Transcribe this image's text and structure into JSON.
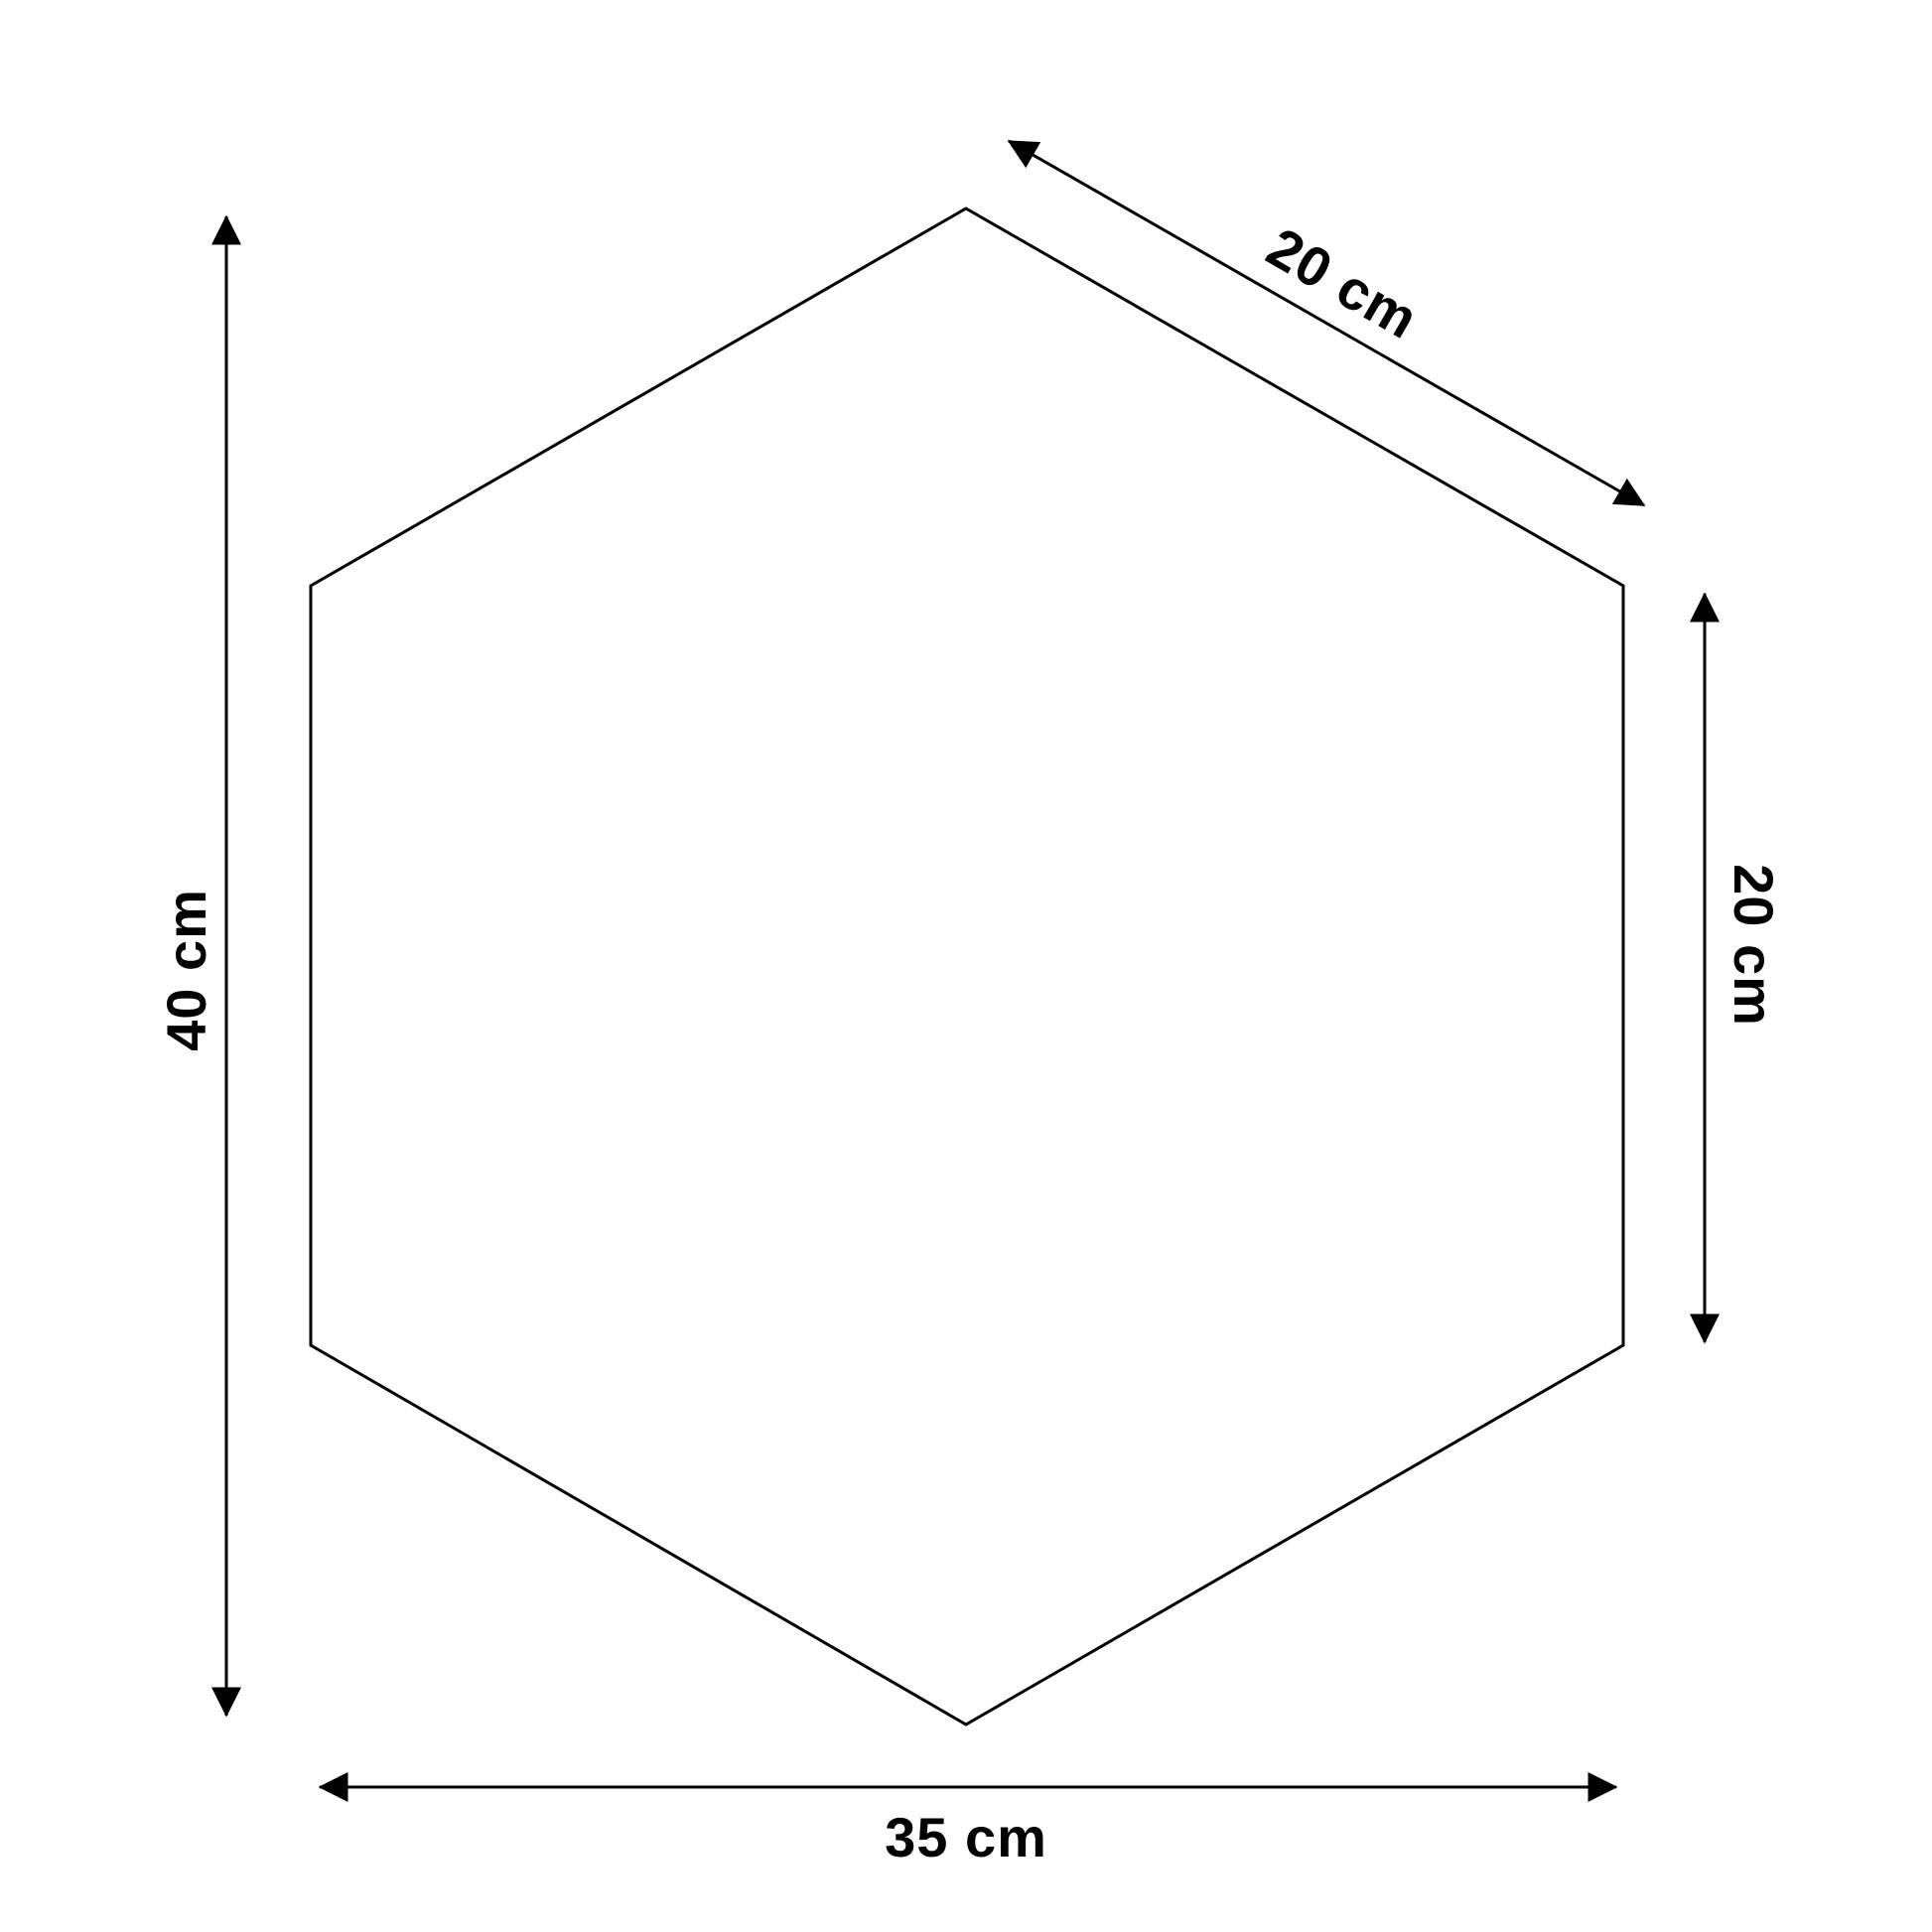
{
  "diagram": {
    "kind": "product-dimension-drawing",
    "shape": "hexagon",
    "dimensions": {
      "height": {
        "label": "40 cm",
        "value": 40,
        "unit": "cm",
        "side": "left"
      },
      "top_edge": {
        "label": "20 cm",
        "value": 20,
        "unit": "cm",
        "side": "top-right-diagonal"
      },
      "right_edge": {
        "label": "20 cm",
        "value": 20,
        "unit": "cm",
        "side": "right"
      },
      "width": {
        "label": "35 cm",
        "value": 35,
        "unit": "cm",
        "side": "bottom"
      }
    },
    "colors": {
      "line": "#000000",
      "text": "#000000",
      "background": "#ffffff"
    }
  }
}
